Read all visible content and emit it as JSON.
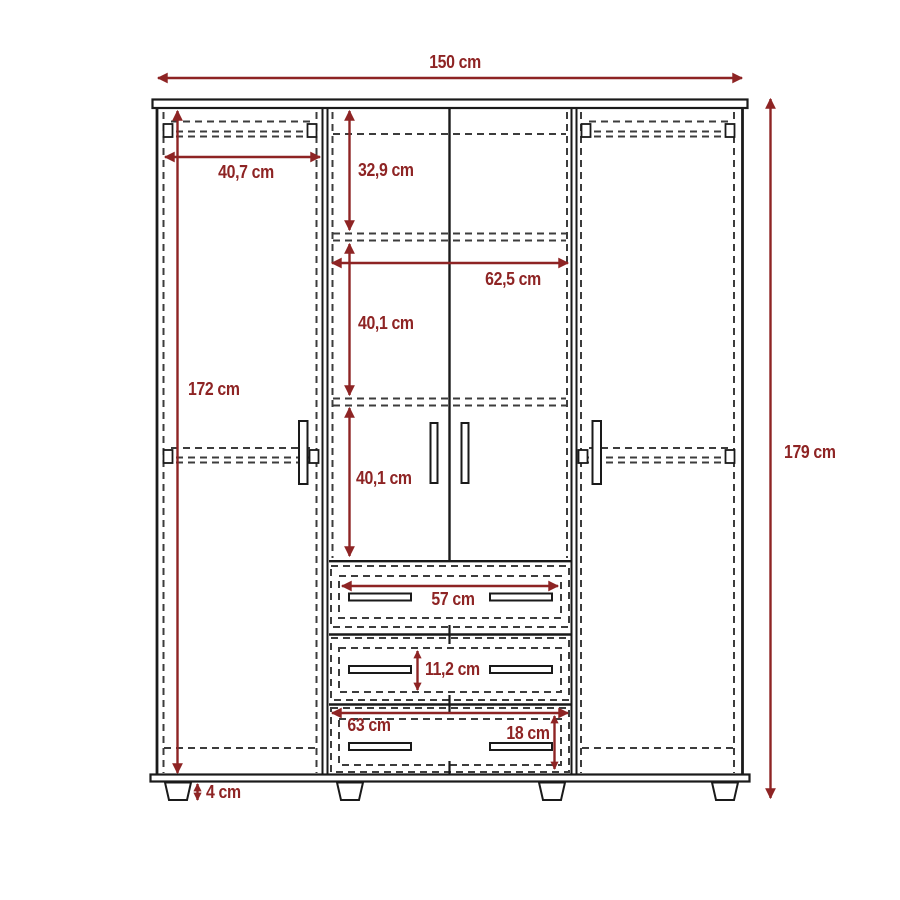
{
  "diagram": {
    "dimensions": {
      "total_width": "150 cm",
      "total_height": "179 cm",
      "interior_height": "172 cm",
      "left_rod_width": "40,7 cm",
      "top_section_height": "32,9 cm",
      "center_width": "62,5 cm",
      "upper_shelf_gap": "40,1 cm",
      "lower_shelf_gap": "40,1 cm",
      "drawer_handle_span": "57 cm",
      "drawer_front_height": "11,2 cm",
      "bottom_drawer_width": "63 cm",
      "bottom_drawer_height": "18 cm",
      "leg_height": "4 cm"
    },
    "colors": {
      "dimension": "#8e2424",
      "outline": "#1a1a1a",
      "hidden_line": "#3c3c3c",
      "background": "#ffffff"
    }
  }
}
